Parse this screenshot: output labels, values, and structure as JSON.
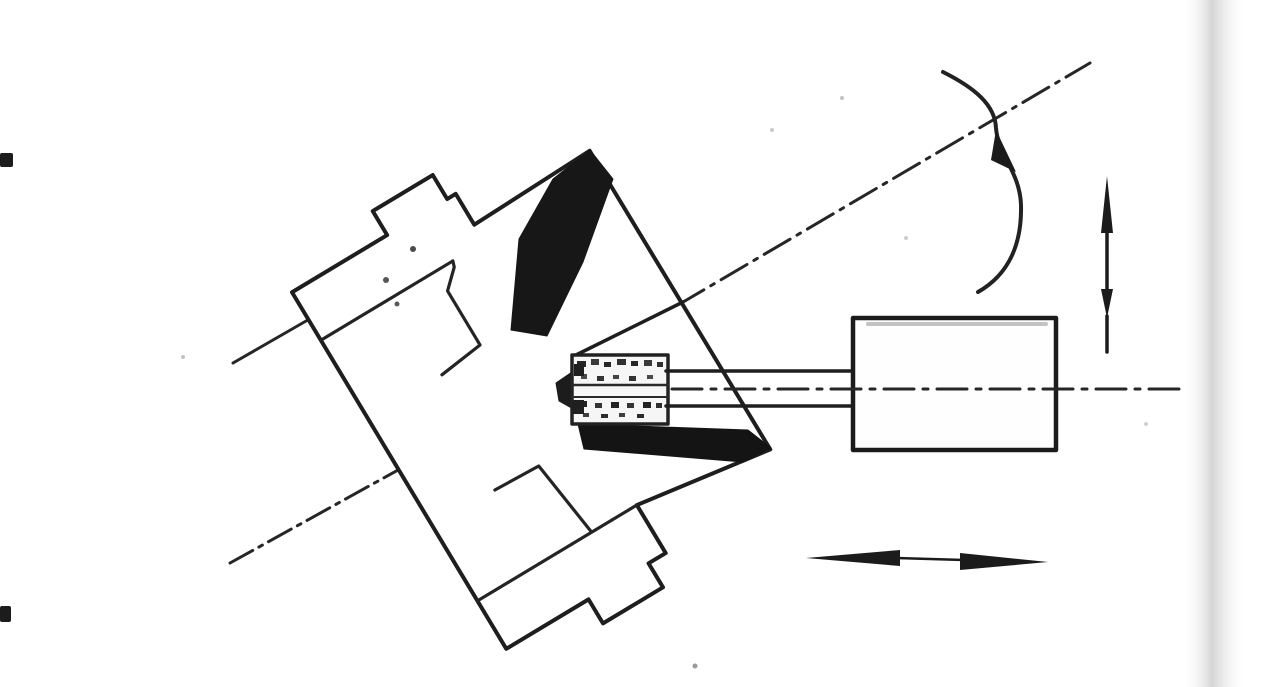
{
  "canvas": {
    "width": 1280,
    "height": 687,
    "background": "#ffffff"
  },
  "colors": {
    "ink": "#1e1e1e",
    "dark_fill": "#171717",
    "white_fill": "#ffffff",
    "wheel_fill": "#f6f6f6",
    "smear": "#8f8f8f",
    "speckle": "#b9b9b9",
    "page_edge": "#d6d6d6"
  },
  "figure": {
    "kind": "scanned-line-drawing",
    "elements": [
      {
        "type": "rect",
        "name": "page-background",
        "x": 0,
        "y": 0,
        "w": 1280,
        "h": 687,
        "fill": "#ffffff"
      },
      {
        "type": "rect",
        "name": "page-edge-shadow",
        "x": 1183,
        "y": 0,
        "w": 64,
        "h": 687,
        "fill": "url(#edge-grad)"
      },
      {
        "type": "rect",
        "name": "margin-dash-top",
        "x": 0,
        "y": 153,
        "w": 13,
        "h": 14,
        "rx": 2,
        "fill": "#1c1c1c"
      },
      {
        "type": "rect",
        "name": "margin-dash-bottom",
        "x": 0,
        "y": 606,
        "w": 11,
        "h": 16,
        "rx": 2,
        "fill": "#1c1c1c"
      },
      {
        "type": "circle",
        "name": "paper-speckle",
        "cx": 183,
        "cy": 357,
        "r": 2,
        "fill": "#c2c2c2"
      },
      {
        "type": "circle",
        "name": "paper-speckle",
        "cx": 695,
        "cy": 666,
        "r": 2.5,
        "fill": "#9a9a9a"
      },
      {
        "type": "circle",
        "name": "paper-speckle",
        "cx": 772,
        "cy": 130,
        "r": 2,
        "fill": "#c9c9c9"
      },
      {
        "type": "circle",
        "name": "paper-speckle",
        "cx": 842,
        "cy": 98,
        "r": 2,
        "fill": "#c2c2c2"
      },
      {
        "type": "circle",
        "name": "paper-speckle",
        "cx": 1146,
        "cy": 424,
        "r": 2,
        "fill": "#cfcfcf"
      },
      {
        "type": "circle",
        "name": "paper-speckle",
        "cx": 906,
        "cy": 238,
        "r": 2,
        "fill": "#cccccc"
      },
      {
        "type": "line",
        "name": "workpiece-axis-centerline-lower",
        "x1": 230,
        "y1": 563,
        "x2": 436,
        "y2": 449,
        "stroke": "#262626",
        "sw": 3,
        "dash": "26 7 4 7"
      },
      {
        "type": "line",
        "name": "workpiece-axis-centerline-upper",
        "x1": 678,
        "y1": 305,
        "x2": 1090,
        "y2": 63,
        "stroke": "#262626",
        "sw": 3,
        "dash": "30 8 4 8"
      },
      {
        "type": "line",
        "name": "axis-centerline-stub",
        "x1": 233,
        "y1": 363,
        "x2": 313,
        "y2": 317,
        "stroke": "#262626",
        "sw": 3
      },
      {
        "type": "polygon",
        "name": "chuck-workpiece-silhouette",
        "transform": "translate(430,452) rotate(-31)",
        "points": [
          [
            -36,
            -152
          ],
          [
            -36,
            -208
          ],
          [
            75,
            -208
          ],
          [
            75,
            -236
          ],
          [
            145,
            -236
          ],
          [
            145,
            -208
          ],
          [
            155,
            -208
          ],
          [
            155,
            -172
          ],
          [
            292,
            -176
          ],
          [
            293,
            173
          ],
          [
            150,
            152
          ],
          [
            150,
            208
          ],
          [
            130,
            208
          ],
          [
            130,
            236
          ],
          [
            60,
            236
          ],
          [
            60,
            208
          ],
          [
            -36,
            208
          ]
        ],
        "fill": "#ffffff",
        "stroke": "#1e1e1e",
        "sw": 4
      },
      {
        "type": "line",
        "name": "chuck-internal-step-upper-bar",
        "transform": "translate(430,452) rotate(-31)",
        "x1": -36,
        "y1": -152,
        "x2": 118,
        "y2": -152,
        "stroke": "#242424",
        "sw": 3.2
      },
      {
        "type": "polyline",
        "name": "chuck-internal-jaw-upper",
        "transform": "translate(430,452) rotate(-31)",
        "points": [
          [
            118,
            -152
          ],
          [
            116,
            -146
          ],
          [
            98,
            -129
          ],
          [
            98,
            -66
          ],
          [
            50,
            -60
          ]
        ],
        "stroke": "#242424",
        "sw": 3.2
      },
      {
        "type": "line",
        "name": "chuck-internal-step-lower-bar",
        "transform": "translate(430,452) rotate(-31)",
        "x1": -36,
        "y1": 152,
        "x2": 150,
        "y2": 152,
        "stroke": "#242424",
        "sw": 3.2
      },
      {
        "type": "polyline",
        "name": "chuck-internal-jaw-lower",
        "transform": "translate(430,452) rotate(-31)",
        "points": [
          [
            36,
            66
          ],
          [
            86,
            68
          ],
          [
            97,
            150
          ]
        ],
        "stroke": "#242424",
        "sw": 3.2
      },
      {
        "type": "circle",
        "name": "chuck-surface-dot",
        "cx": 413,
        "cy": 249,
        "r": 3,
        "fill": "#4a4a4a"
      },
      {
        "type": "circle",
        "name": "chuck-surface-dot",
        "cx": 386,
        "cy": 280,
        "r": 3,
        "fill": "#555555"
      },
      {
        "type": "circle",
        "name": "chuck-surface-dot",
        "cx": 397,
        "cy": 304,
        "r": 2.5,
        "fill": "#5a5a5a"
      },
      {
        "type": "polygon",
        "name": "workpiece-cone-shaded-face",
        "points": [
          [
            590,
            150
          ],
          [
            613,
            179
          ],
          [
            583,
            262
          ],
          [
            547,
            336
          ],
          [
            511,
            330
          ],
          [
            519,
            239
          ],
          [
            553,
            179
          ]
        ],
        "fill": "#171717",
        "stroke": "#171717",
        "sw": 1
      },
      {
        "type": "line",
        "name": "workpiece-front-face-inner-edge",
        "x1": 683,
        "y1": 302,
        "x2": 576,
        "y2": 355,
        "stroke": "#1e1e1e",
        "sw": 3.5
      },
      {
        "type": "polygon",
        "name": "bore-shaded-underside",
        "points": [
          [
            578,
            424
          ],
          [
            748,
            430
          ],
          [
            771,
            448
          ],
          [
            743,
            462
          ],
          [
            584,
            449
          ]
        ],
        "fill": "#141414",
        "stroke": "#141414",
        "sw": 1
      },
      {
        "type": "polygon",
        "name": "wheel-contact-shadow",
        "points": [
          [
            556,
            383
          ],
          [
            572,
            372
          ],
          [
            575,
            410
          ],
          [
            559,
            401
          ]
        ],
        "fill": "#1c1c1c",
        "stroke": "#1c1c1c",
        "sw": 1
      },
      {
        "type": "rect",
        "name": "grinding-wheel-body",
        "x": 572,
        "y": 355,
        "w": 96,
        "h": 69,
        "fill": "#f6f6f6",
        "stroke": "#222222",
        "sw": 3.5
      },
      {
        "type": "line",
        "name": "grinding-wheel-inner-line-upper",
        "x1": 572,
        "y1": 385,
        "x2": 668,
        "y2": 385,
        "stroke": "#2a2a2a",
        "sw": 2.5
      },
      {
        "type": "line",
        "name": "grinding-wheel-inner-line-lower",
        "x1": 572,
        "y1": 397,
        "x2": 668,
        "y2": 397,
        "stroke": "#2a2a2a",
        "sw": 2
      },
      {
        "type": "rect",
        "name": "wheel-grain",
        "x": 577,
        "y": 361,
        "w": 9,
        "h": 6,
        "fill": "#262626"
      },
      {
        "type": "rect",
        "name": "wheel-grain",
        "x": 591,
        "y": 359,
        "w": 8,
        "h": 6,
        "fill": "#3a3a3a"
      },
      {
        "type": "rect",
        "name": "wheel-grain",
        "x": 604,
        "y": 362,
        "w": 7,
        "h": 5,
        "fill": "#262626"
      },
      {
        "type": "rect",
        "name": "wheel-grain",
        "x": 617,
        "y": 359,
        "w": 9,
        "h": 6,
        "fill": "#303030"
      },
      {
        "type": "rect",
        "name": "wheel-grain",
        "x": 631,
        "y": 361,
        "w": 7,
        "h": 5,
        "fill": "#262626"
      },
      {
        "type": "rect",
        "name": "wheel-grain",
        "x": 644,
        "y": 360,
        "w": 8,
        "h": 6,
        "fill": "#3a3a3a"
      },
      {
        "type": "rect",
        "name": "wheel-grain",
        "x": 657,
        "y": 362,
        "w": 6,
        "h": 5,
        "fill": "#303030"
      },
      {
        "type": "rect",
        "name": "wheel-grain",
        "x": 581,
        "y": 374,
        "w": 6,
        "h": 5,
        "fill": "#4a4a4a"
      },
      {
        "type": "rect",
        "name": "wheel-grain",
        "x": 597,
        "y": 376,
        "w": 7,
        "h": 5,
        "fill": "#333333"
      },
      {
        "type": "rect",
        "name": "wheel-grain",
        "x": 613,
        "y": 375,
        "w": 6,
        "h": 4,
        "fill": "#444444"
      },
      {
        "type": "rect",
        "name": "wheel-grain",
        "x": 629,
        "y": 376,
        "w": 7,
        "h": 5,
        "fill": "#333333"
      },
      {
        "type": "rect",
        "name": "wheel-grain",
        "x": 647,
        "y": 375,
        "w": 6,
        "h": 4,
        "fill": "#4a4a4a"
      },
      {
        "type": "rect",
        "name": "wheel-grain",
        "x": 579,
        "y": 401,
        "w": 8,
        "h": 6,
        "fill": "#232323"
      },
      {
        "type": "rect",
        "name": "wheel-grain",
        "x": 595,
        "y": 403,
        "w": 7,
        "h": 5,
        "fill": "#353535"
      },
      {
        "type": "rect",
        "name": "wheel-grain",
        "x": 611,
        "y": 402,
        "w": 8,
        "h": 6,
        "fill": "#232323"
      },
      {
        "type": "rect",
        "name": "wheel-grain",
        "x": 627,
        "y": 403,
        "w": 7,
        "h": 5,
        "fill": "#353535"
      },
      {
        "type": "rect",
        "name": "wheel-grain",
        "x": 643,
        "y": 402,
        "w": 8,
        "h": 6,
        "fill": "#232323"
      },
      {
        "type": "rect",
        "name": "wheel-grain",
        "x": 656,
        "y": 403,
        "w": 6,
        "h": 5,
        "fill": "#2e2e2e"
      },
      {
        "type": "rect",
        "name": "wheel-grain",
        "x": 583,
        "y": 413,
        "w": 6,
        "h": 4,
        "fill": "#3f3f3f"
      },
      {
        "type": "rect",
        "name": "wheel-grain",
        "x": 601,
        "y": 414,
        "w": 7,
        "h": 4,
        "fill": "#2b2b2b"
      },
      {
        "type": "rect",
        "name": "wheel-grain",
        "x": 619,
        "y": 413,
        "w": 6,
        "h": 4,
        "fill": "#3f3f3f"
      },
      {
        "type": "rect",
        "name": "wheel-grain",
        "x": 637,
        "y": 414,
        "w": 7,
        "h": 4,
        "fill": "#2b2b2b"
      },
      {
        "type": "rect",
        "name": "wheel-grain",
        "x": 574,
        "y": 364,
        "w": 10,
        "h": 12,
        "fill": "#1f1f1f"
      },
      {
        "type": "rect",
        "name": "wheel-grain",
        "x": 572,
        "y": 400,
        "w": 12,
        "h": 14,
        "fill": "#1f1f1f"
      },
      {
        "type": "line",
        "name": "spindle-shaft-top-edge",
        "x1": 666,
        "y1": 371,
        "x2": 854,
        "y2": 371,
        "stroke": "#1e1e1e",
        "sw": 3.5
      },
      {
        "type": "line",
        "name": "spindle-shaft-bottom-edge",
        "x1": 666,
        "y1": 406,
        "x2": 854,
        "y2": 406,
        "stroke": "#1e1e1e",
        "sw": 3.5
      },
      {
        "type": "rect",
        "name": "spindle-motor-housing",
        "x": 853,
        "y": 318,
        "w": 203,
        "h": 132,
        "fill": "#fefefe",
        "stroke": "#1b1b1b",
        "sw": 4.5
      },
      {
        "type": "line",
        "name": "housing-scan-smear",
        "x1": 868,
        "y1": 324,
        "x2": 1046,
        "y2": 324,
        "stroke": "#8f8f8f",
        "sw": 4,
        "opacity": 0.55
      },
      {
        "type": "line",
        "name": "spindle-axis-centerline",
        "x1": 672,
        "y1": 389,
        "x2": 1188,
        "y2": 389,
        "stroke": "#262626",
        "sw": 3,
        "dash": "30 9 5 9"
      },
      {
        "type": "path",
        "name": "rotation-arc",
        "d": "M 943 72 C 975 88 995 105 996 128 C 998 155 1020 172 1021 205 C 1022 245 1008 275 978 292",
        "fill": "none",
        "stroke": "#222222",
        "sw": 4
      },
      {
        "type": "polygon",
        "name": "rotation-arc-arrowhead",
        "points": [
          [
            996,
            130
          ],
          [
            1016,
            172
          ],
          [
            991,
            160
          ]
        ],
        "fill": "#1b1b1b",
        "stroke": "none",
        "sw": 0
      },
      {
        "type": "line",
        "name": "vertical-feed-arrow-shaft",
        "x1": 1107,
        "y1": 222,
        "x2": 1107,
        "y2": 292,
        "stroke": "#1b1b1b",
        "sw": 3.5
      },
      {
        "type": "polygon",
        "name": "vertical-feed-arrowhead-up",
        "points": [
          [
            1107,
            176
          ],
          [
            1101,
            233
          ],
          [
            1113,
            233
          ]
        ],
        "fill": "#1b1b1b",
        "stroke": "none",
        "sw": 0
      },
      {
        "type": "polygon",
        "name": "vertical-feed-arrowhead-down",
        "points": [
          [
            1107,
            318
          ],
          [
            1101,
            289
          ],
          [
            1113,
            289
          ]
        ],
        "fill": "#1b1b1b",
        "stroke": "none",
        "sw": 0
      },
      {
        "type": "line",
        "name": "vertical-feed-arrow-tail",
        "x1": 1107,
        "y1": 316,
        "x2": 1107,
        "y2": 352,
        "stroke": "#1b1b1b",
        "sw": 3.5
      },
      {
        "type": "line",
        "name": "horizontal-feed-arrow-shaft",
        "x1": 896,
        "y1": 558,
        "x2": 964,
        "y2": 560,
        "stroke": "#1b1b1b",
        "sw": 2.5
      },
      {
        "type": "polygon",
        "name": "horizontal-feed-arrowhead-left",
        "points": [
          [
            806,
            558
          ],
          [
            900,
            550
          ],
          [
            900,
            566
          ]
        ],
        "fill": "#1b1b1b",
        "stroke": "none",
        "sw": 0
      },
      {
        "type": "polygon",
        "name": "horizontal-feed-arrowhead-right",
        "points": [
          [
            1048,
            562
          ],
          [
            960,
            553
          ],
          [
            960,
            570
          ]
        ],
        "fill": "#1b1b1b",
        "stroke": "none",
        "sw": 0
      }
    ]
  }
}
